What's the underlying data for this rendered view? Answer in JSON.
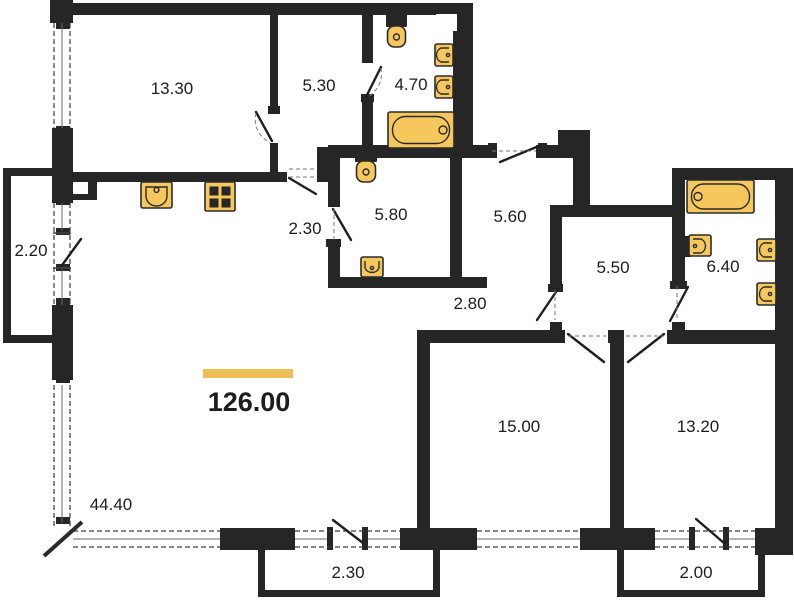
{
  "theme": {
    "background": "#ffffff",
    "wall_color": "#262626",
    "fixture_fill": "#F5C75C",
    "fixture_stroke": "#2b2b2b",
    "accent_color": "#EFBD55",
    "label_color": "#1d1d1d"
  },
  "plan": {
    "total_area_label": "126.00",
    "rooms": [
      {
        "name": "room-top-left",
        "area_label": "13.30"
      },
      {
        "name": "hallway-top",
        "area_label": "5.30"
      },
      {
        "name": "bathroom-top",
        "area_label": "4.70"
      },
      {
        "name": "balcony-left",
        "area_label": "2.20"
      },
      {
        "name": "corridor-mid",
        "area_label": "2.30"
      },
      {
        "name": "bathroom-mid",
        "area_label": "5.80"
      },
      {
        "name": "entry-hall",
        "area_label": "5.60"
      },
      {
        "name": "hall",
        "area_label": "5.50"
      },
      {
        "name": "bathroom-right",
        "area_label": "6.40"
      },
      {
        "name": "corridor-lower",
        "area_label": "2.80"
      },
      {
        "name": "bedroom-bottom-middle",
        "area_label": "15.00"
      },
      {
        "name": "bedroom-bottom-right",
        "area_label": "13.20"
      },
      {
        "name": "living-kitchen",
        "area_label": "44.40"
      },
      {
        "name": "balcony-bottom-middle",
        "area_label": "2.30"
      },
      {
        "name": "balcony-bottom-right",
        "area_label": "2.00"
      }
    ],
    "fixture_icons": [
      "kitchen-sink",
      "stove",
      "toilet",
      "washbasin",
      "bathtub"
    ]
  }
}
